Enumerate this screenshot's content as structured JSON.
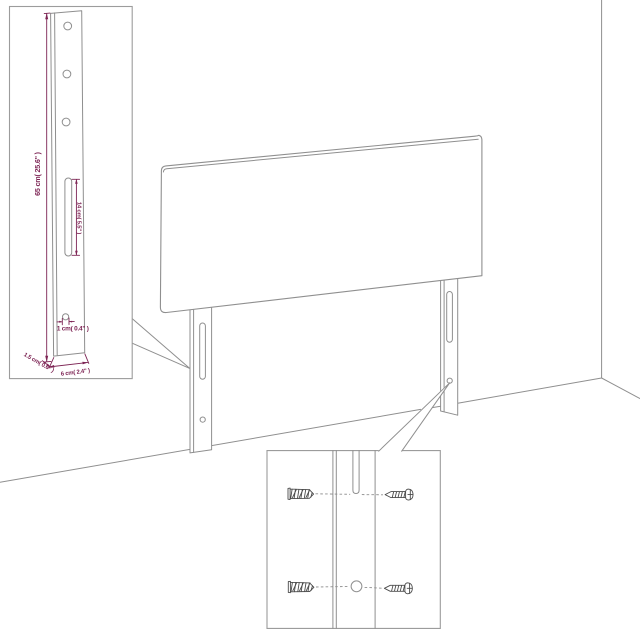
{
  "diagram": {
    "type": "headboard dimension diagram",
    "detail_inset": {
      "height_label": "65 cm( 25.6\" )",
      "slot_label": "14 cm( 5.5\" )",
      "hole_label": "1 cm( 0.4\" )",
      "depth_label": "1.5 cm( 0.6\" )",
      "width_label": "6 cm( 2.4\" )"
    },
    "hardware_inset": {
      "items": [
        "wall-plug",
        "screw",
        "wall-plug",
        "screw"
      ]
    },
    "colors": {
      "line_gray": "#8f8f8f",
      "dim_magenta": "#7d2454",
      "hardware_dark": "#4b4b4b",
      "border_gray": "#9c9c9c",
      "background": "#ffffff"
    }
  }
}
